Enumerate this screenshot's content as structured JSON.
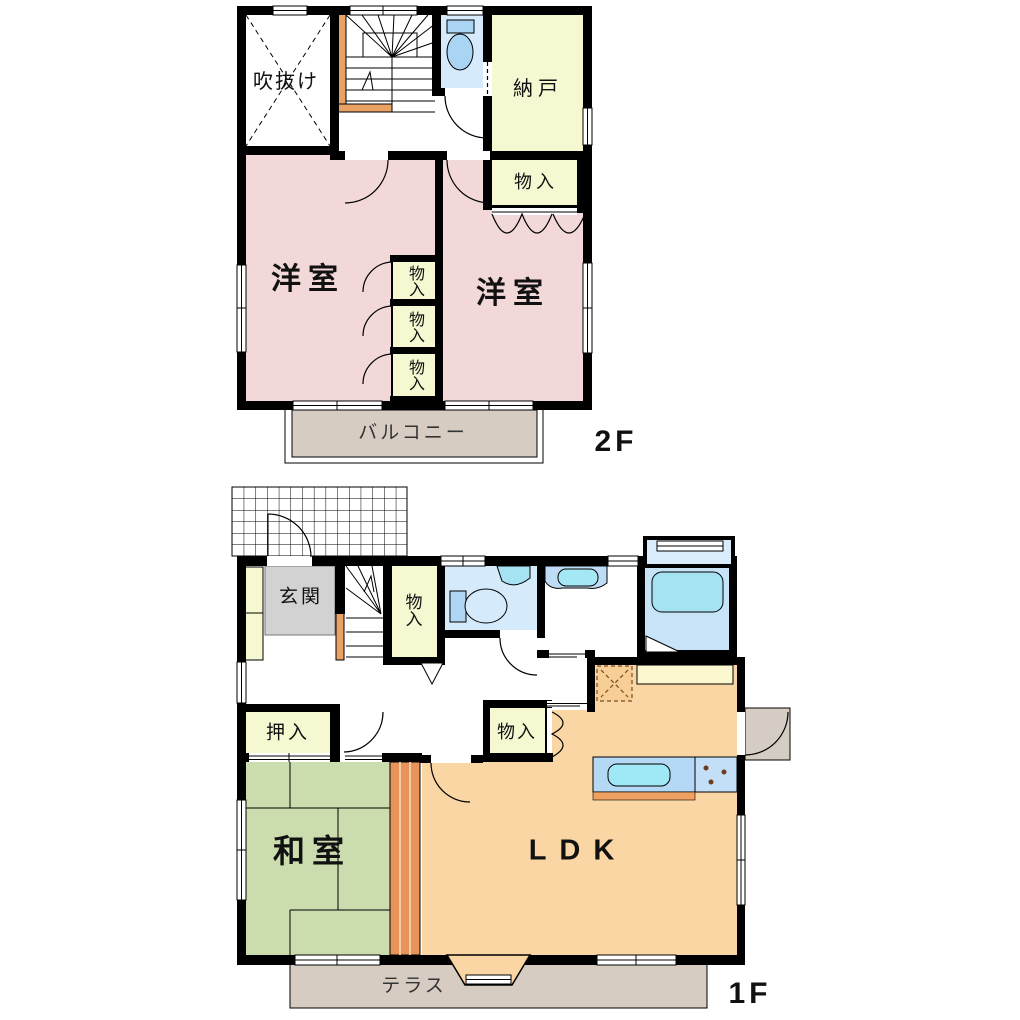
{
  "palette": {
    "wall": "#000000",
    "bedroom_pink": "#F2D8D8",
    "closet_yellow": "#F6F8D2",
    "ldk_orange": "#FAD6A4",
    "tatami_green": "#CBDCAE",
    "balcony_tan": "#D6CCC2",
    "entry_gray": "#D2D2D2",
    "water_room_blue": "#D5EAFA",
    "fixture_blue": "#A9D4F4",
    "tub_cyan": "#A5E3F3",
    "stair_rail_orange": "#E9A263",
    "counter_yellow": "#FBF8D0",
    "divider_orange": "#E8935A"
  },
  "floor2": {
    "label": "2F",
    "rooms": {
      "void": "吹抜け",
      "storage": "納戸",
      "closet_top": "物入",
      "bedroom_left": "洋室",
      "bedroom_right": "洋室",
      "closet1": "物入",
      "closet2": "物入",
      "closet3": "物入",
      "balcony": "バルコニー"
    }
  },
  "floor1": {
    "label": "1F",
    "rooms": {
      "entrance": "玄関",
      "stair_closet": "物入",
      "hall_closet": "物入",
      "oshiire": "押入",
      "japanese_room": "和室",
      "ldk": "LDK",
      "terrace": "テラス"
    }
  }
}
